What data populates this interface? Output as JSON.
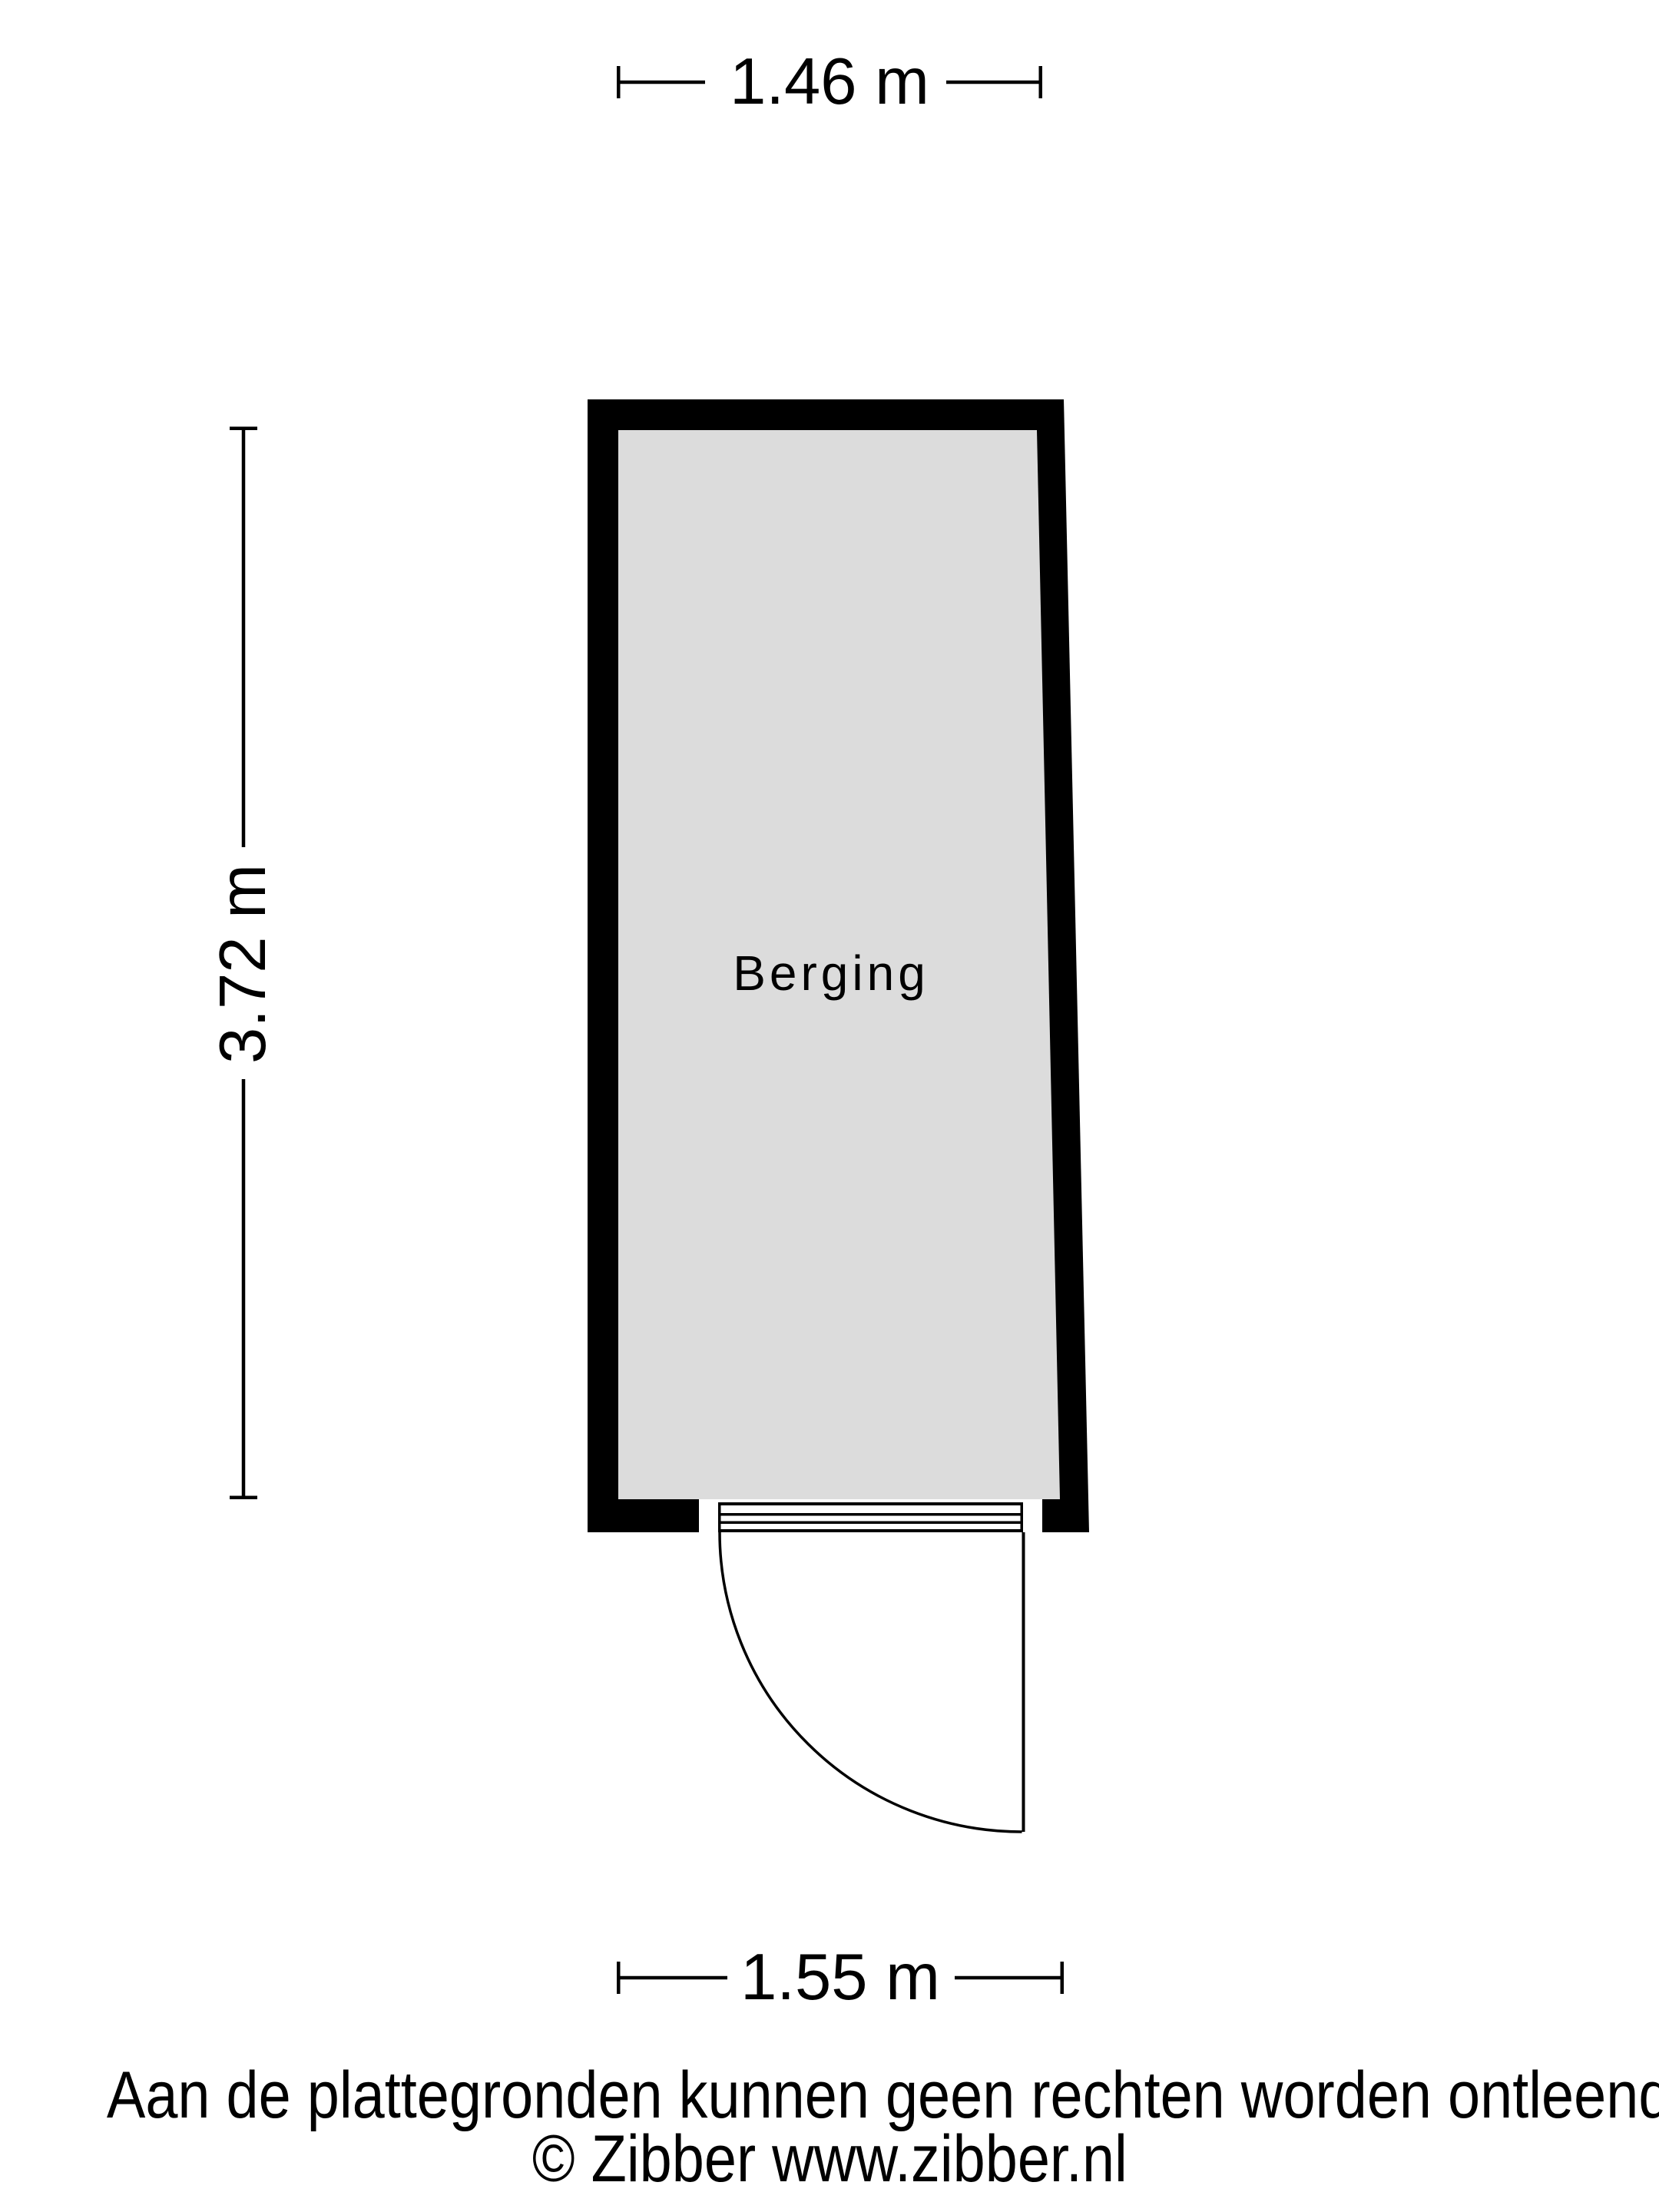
{
  "colors": {
    "background": "#ffffff",
    "wall": "#000000",
    "floor": "#dcdcdc",
    "line": "#000000",
    "text": "#000000"
  },
  "floorplan": {
    "room": {
      "label": "Berging"
    },
    "dimensions": {
      "top": {
        "label": "1.46 m"
      },
      "left": {
        "label": "3.72 m"
      },
      "bottom": {
        "label": "1.55 m"
      }
    }
  },
  "footer": {
    "disclaimer": "Aan de plattegronden kunnen geen rechten worden ontleend",
    "copyright": "© Zibber www.zibber.nl"
  }
}
